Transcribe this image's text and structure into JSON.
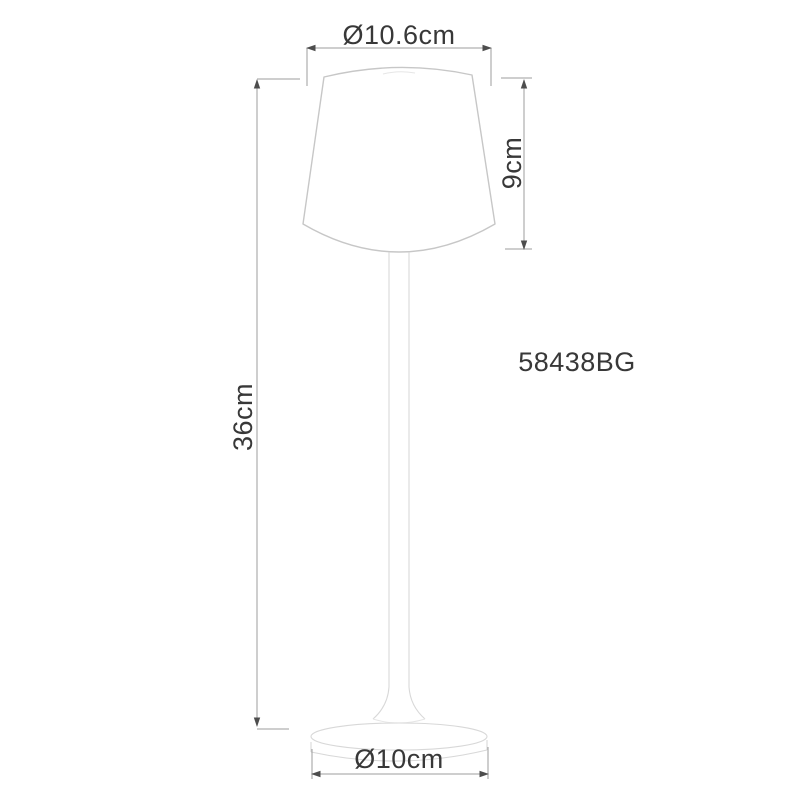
{
  "drawing": {
    "type": "product-dimension-diagram",
    "subject": "table lamp line drawing",
    "labels": {
      "top_diameter": "Ø10.6cm",
      "shade_height": "9cm",
      "total_height": "36cm",
      "base_diameter": "Ø10cm",
      "model_number": "58438BG"
    }
  },
  "colors": {
    "background": "#ffffff",
    "text": "#383838",
    "dim_line": "#9c9c9c",
    "arrow": "#4d4d4d",
    "shade_line": "#c7c7c7",
    "body_line": "#d8d8d8",
    "faint_line": "#e6e6e6"
  }
}
